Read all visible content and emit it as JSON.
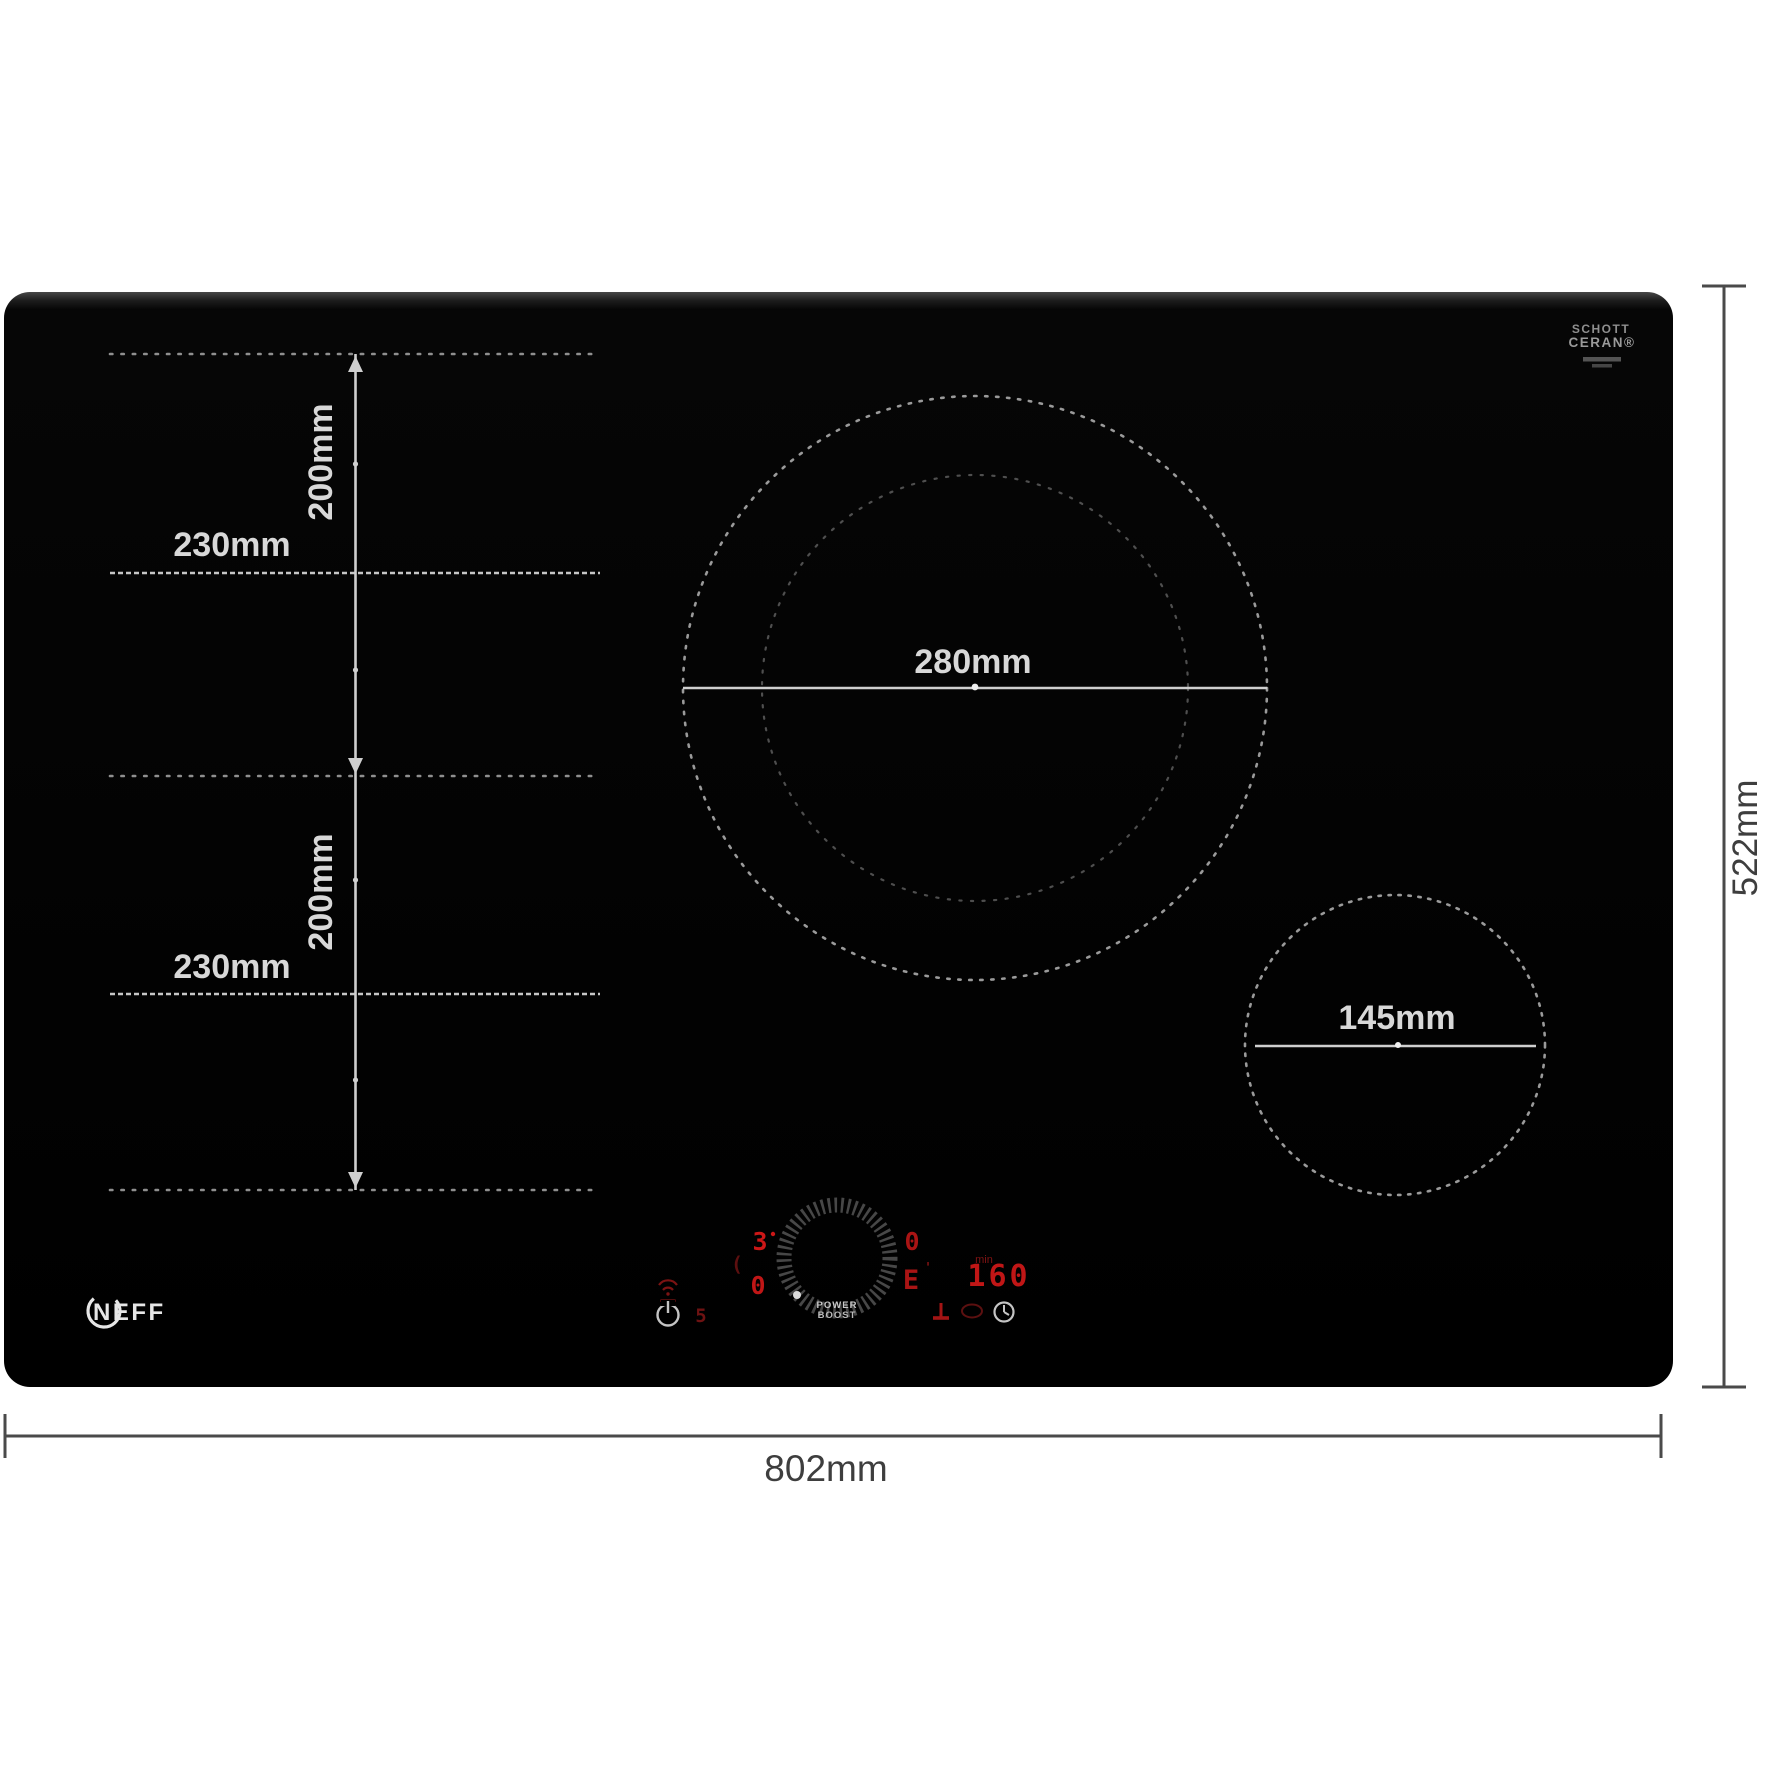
{
  "diagram": {
    "brand": "NEFF",
    "glass_logo": {
      "line1": "SCHOTT",
      "line2": "CERAN®"
    },
    "labels": {
      "overall_width": "802mm",
      "overall_depth": "522mm",
      "flex_top_width": "230mm",
      "flex_top_height": "200mm",
      "flex_bottom_width": "230mm",
      "flex_bottom_height": "200mm",
      "large_zone": "280mm",
      "small_zone": "145mm"
    },
    "display": {
      "left_level": "3",
      "left_sub": "0",
      "left_bracket": "(",
      "left_small": "5",
      "right_level": "0",
      "right_sub": "E",
      "right_tick": "'",
      "timer_unit": "min",
      "timer": "160",
      "knob_line1": "POWER",
      "knob_line2": "BOOST"
    },
    "colors": {
      "display_red": "#c41616",
      "display_red_dim": "#6a1111",
      "zone_line_gray": "#9a9a9a",
      "dimension_gray": "#4a4a4a",
      "panel_black": "#000000"
    }
  }
}
